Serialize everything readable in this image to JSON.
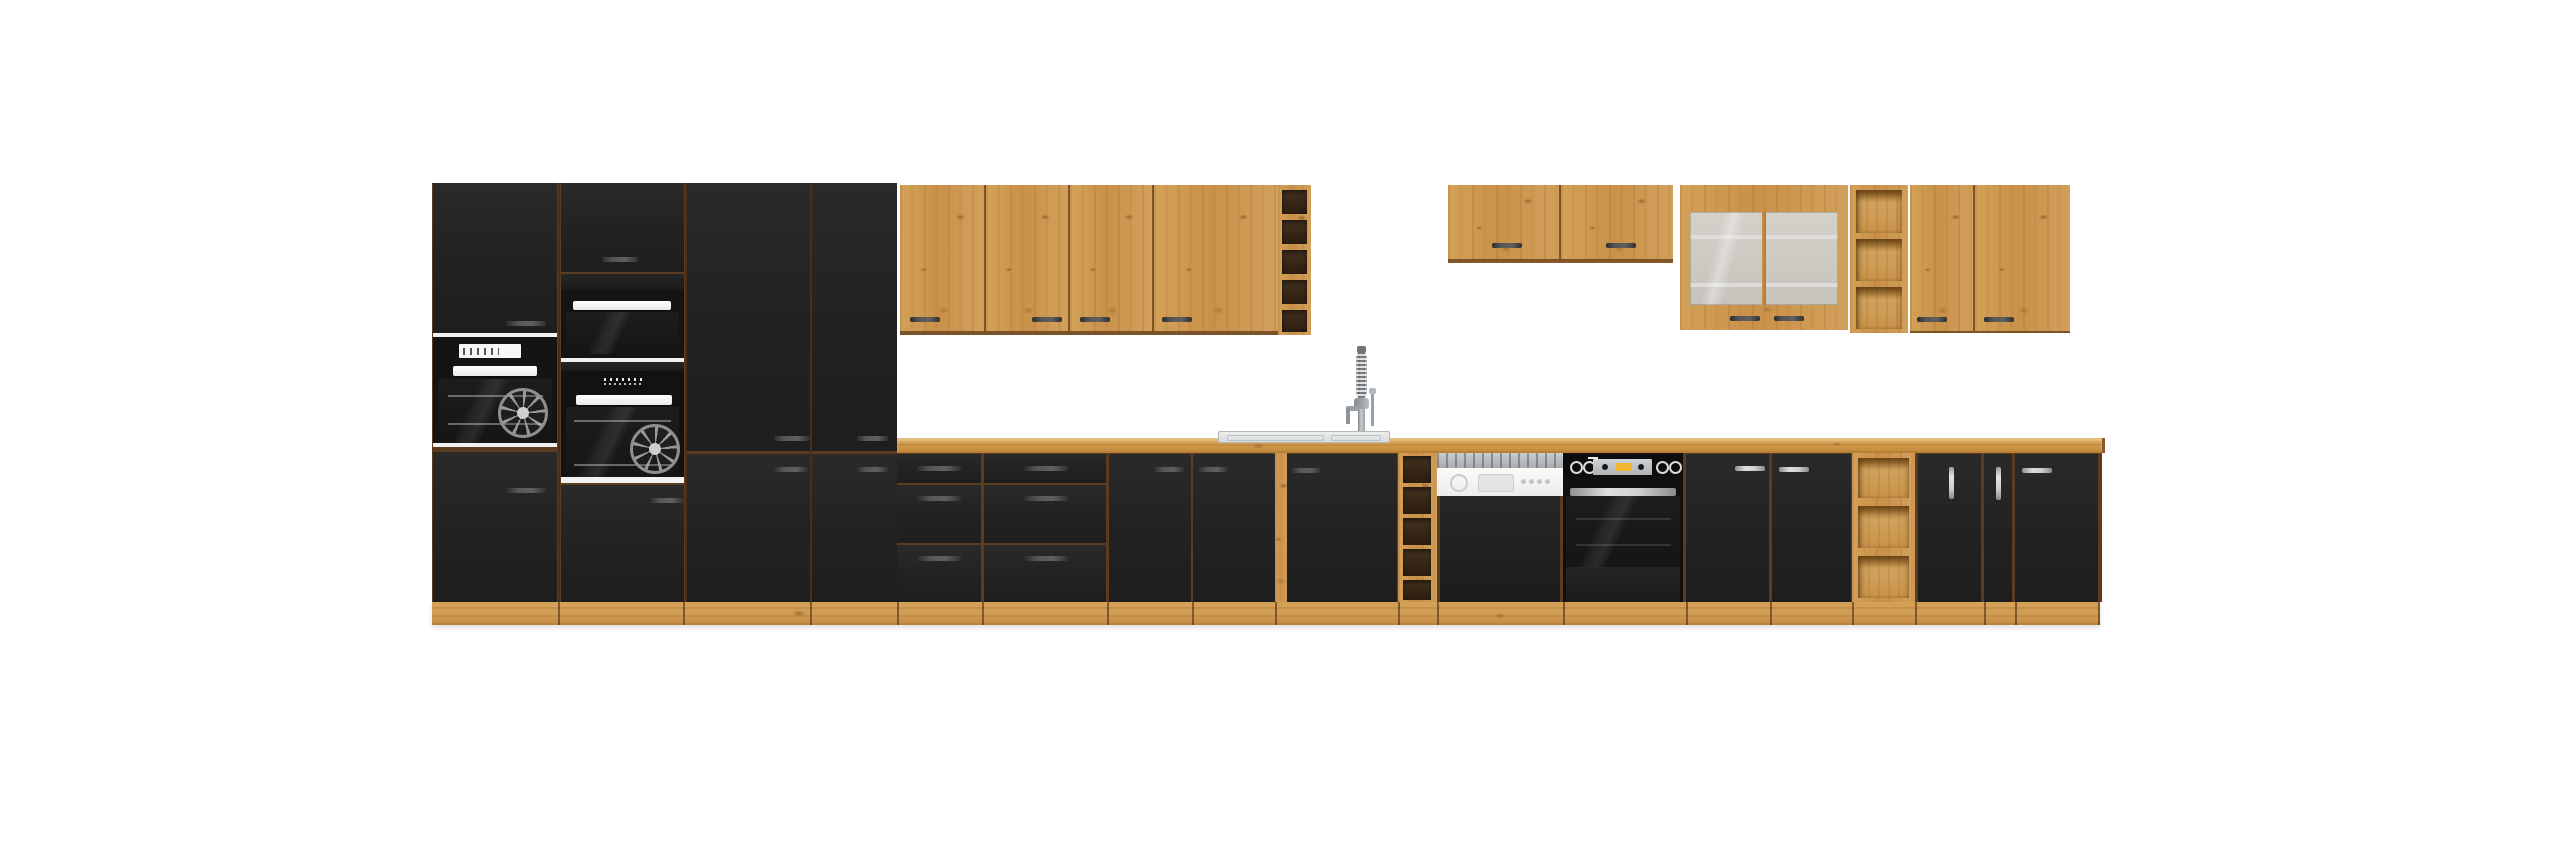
{
  "scene": {
    "type": "product render",
    "description": "Modular kitchen furniture set, black matt fronts with artisan oak carcass, worktop and wall units, on white background",
    "background_color": "#ffffff"
  },
  "palette": {
    "front_black": "#232323",
    "oak_light": "#d2a05b",
    "oak_mid": "#c9914a",
    "oak_grain": "#975f23",
    "worktop_oak": "#cd9748",
    "seam_brown": "#5c3c1f",
    "handle_dark": "#4a4a4a",
    "handle_silver": "#c9c9c9",
    "appliance_white": "#f1f1ef",
    "appliance_glass": "#161616",
    "steel": "#b8bcbe",
    "display_silver": "#c3c8cc",
    "display_yellow": "#f2b531",
    "rack_opening": "#352515"
  },
  "furniture": {
    "tall_units": {
      "title": "Tall oven housing and pantry columns",
      "columns": [
        {
          "name": "oven column A",
          "appliances": [
            "built-in oven with display"
          ],
          "doors": 2
        },
        {
          "name": "oven column B",
          "appliances": [
            "compact built-in oven",
            "built-in fan oven"
          ],
          "doors": 2
        },
        {
          "name": "tall pantry 60",
          "doors": 2
        },
        {
          "name": "tall pantry 40",
          "doors": 2
        }
      ]
    },
    "wall_units_middle": {
      "title": "Oak wall cabinets above sink",
      "doors": 4,
      "wine_rack_openings": 5
    },
    "wall_units_right": {
      "title": "Right oak wall cabinets",
      "items": [
        "double wall cabinet short",
        "glass display cabinet",
        "open shelf column",
        "double wall cabinet"
      ]
    },
    "worktop": {
      "title": "Oak worktop",
      "sink": "inset stainless sink",
      "tap": "spring pull-out mixer tap"
    },
    "base_units": {
      "title": "Base cabinets",
      "items": [
        "3-drawer unit 40",
        "3-drawer unit 60",
        "sink cabinet 80 two doors",
        "single door cabinet 50",
        "wine rack column 20",
        "semi-integrated dishwasher 60",
        "built-in oven 60 with knobs and yellow display",
        "door cabinet 40",
        "door cabinet 40",
        "open shelf unit 30",
        "door cabinet 30 vertical handle",
        "cargo pull-out 15",
        "door cabinet 40"
      ]
    },
    "plinth": {
      "title": "Oak plinth"
    }
  }
}
